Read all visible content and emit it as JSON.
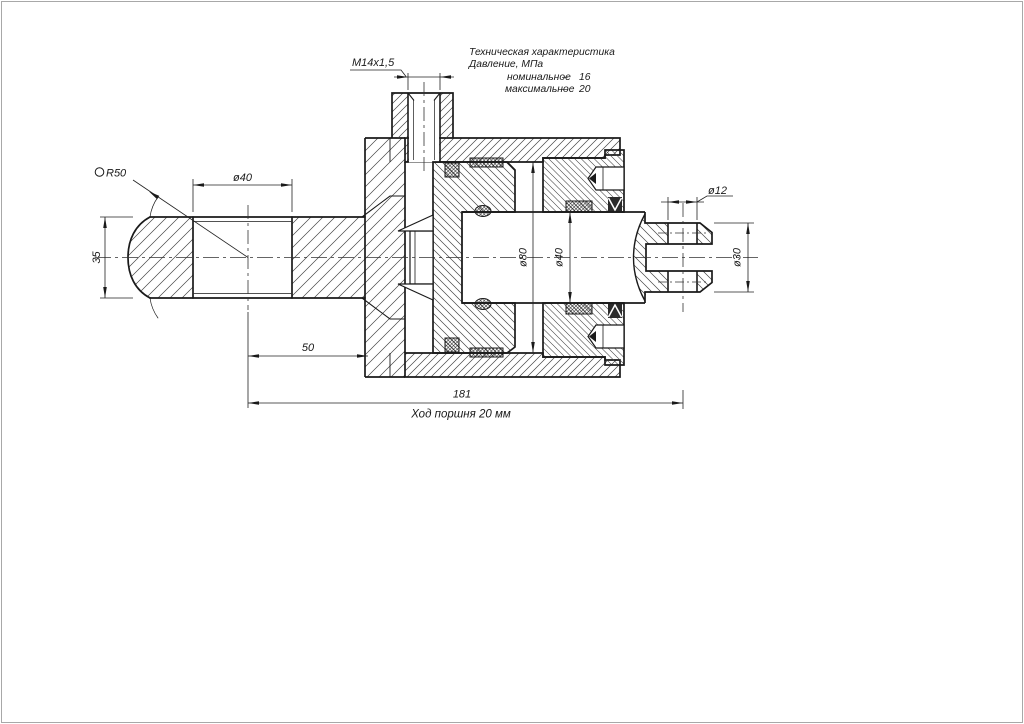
{
  "canvas": {
    "background": "#ffffff",
    "line_color": "#1a1a1a",
    "frame_color": "#a8a8a8"
  },
  "tech_spec": {
    "title": "Техническая характеристика",
    "subtitle": "Давление, МПа",
    "rows": [
      {
        "label": "номинальное",
        "dash": "–",
        "value": "16"
      },
      {
        "label": "максимальное",
        "dash": "–",
        "value": "20"
      }
    ]
  },
  "dimensions": {
    "port_thread": "M14x1,5",
    "sphere_radius": "R50",
    "eye_hole_diameter": "ø40",
    "eye_width": "35",
    "eye_center_to_body": "50",
    "bore_diameter": "ø80",
    "rod_diameter": "ø40",
    "pin_hole_diameter": "ø12",
    "clevis_diameter": "ø30",
    "center_to_center_length": "181",
    "stroke_note": "Ход поршня 20 мм"
  }
}
